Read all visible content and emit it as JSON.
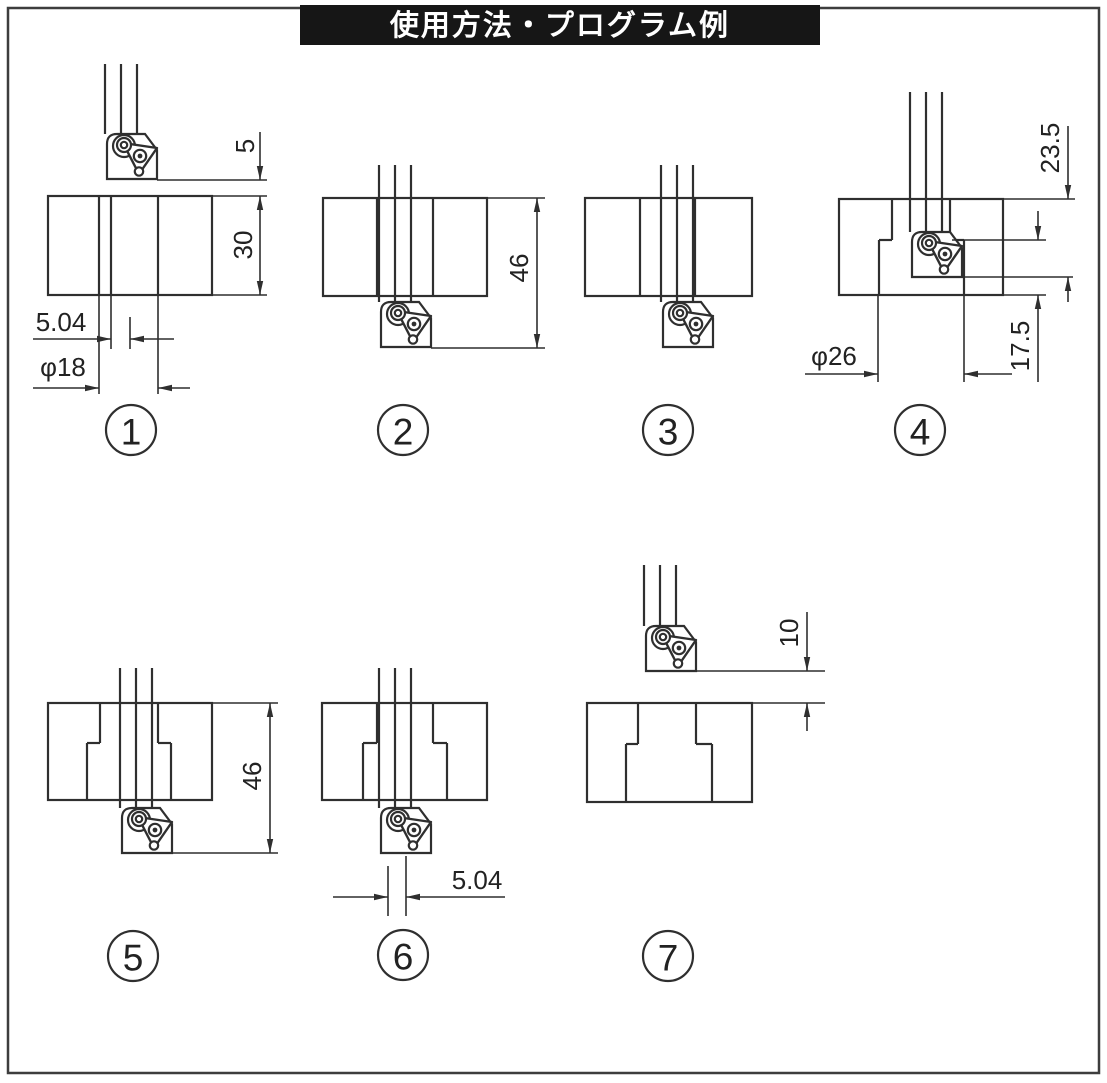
{
  "header": {
    "title": "使用方法・プログラム例"
  },
  "figures": [
    {
      "number": "1",
      "dimensions": {
        "clearance_top": "5",
        "workpiece_height": "30",
        "offset": "5.04",
        "bore_diameter": "φ18"
      }
    },
    {
      "number": "2",
      "dimensions": {
        "plunge_depth": "46"
      }
    },
    {
      "number": "3",
      "dimensions": {}
    },
    {
      "number": "4",
      "dimensions": {
        "depth_to_tool_bottom": "23.5",
        "shoulder_height": "17.5",
        "groove_diameter": "φ26"
      }
    },
    {
      "number": "5",
      "dimensions": {
        "plunge_depth": "46"
      }
    },
    {
      "number": "6",
      "dimensions": {
        "offset": "5.04"
      }
    },
    {
      "number": "7",
      "dimensions": {
        "retract_clearance": "10"
      }
    }
  ]
}
